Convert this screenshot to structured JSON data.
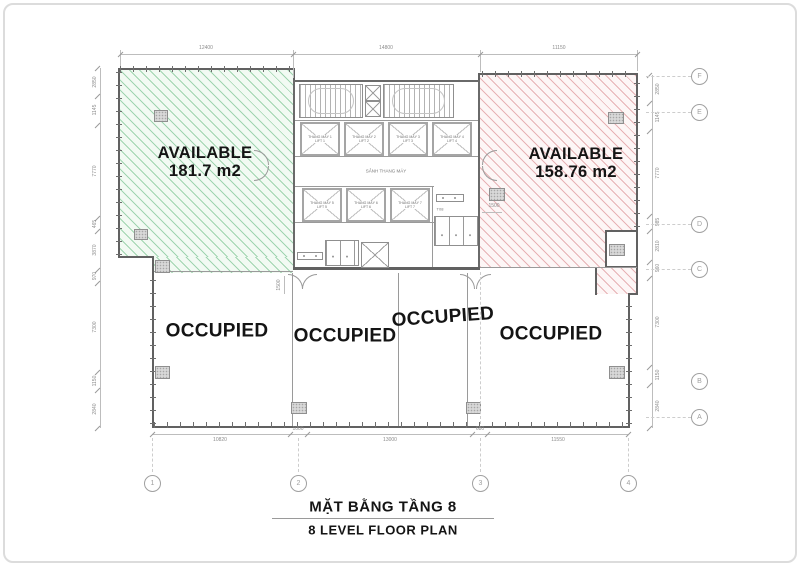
{
  "sheet": {
    "title_vi": "MẶT BẰNG TẦNG 8",
    "title_en": "8 LEVEL FLOOR PLAN"
  },
  "areas": {
    "available_left": {
      "name": "AVAILABLE",
      "area": "181.7 m2"
    },
    "available_right": {
      "name": "AVAILABLE",
      "area": "158.76 m2"
    },
    "occupied": [
      "OCCUPIED",
      "OCCUPIED",
      "OCCUPIED",
      "OCCUPIED"
    ]
  },
  "core": {
    "lobby": "SẢNH THANG MÁY",
    "wc": "T08",
    "lifts_top": [
      {
        "name": "THANG MÁY 1",
        "sub": "LIFT 1"
      },
      {
        "name": "THANG MÁY 2",
        "sub": "LIFT 2"
      },
      {
        "name": "THANG MÁY 3",
        "sub": "LIFT 3"
      },
      {
        "name": "THANG MÁY 4",
        "sub": "LIFT 4"
      }
    ],
    "lifts_bottom": [
      {
        "name": "THANG MÁY 5",
        "sub": "LIFT 5"
      },
      {
        "name": "THANG MÁY 6",
        "sub": "LIFT 6"
      },
      {
        "name": "THANG MÁY 7",
        "sub": "LIFT 7"
      }
    ]
  },
  "grid": {
    "cols": [
      "1",
      "2",
      "3",
      "4"
    ],
    "rows": [
      "F",
      "E",
      "D",
      "C",
      "B",
      "A"
    ]
  },
  "dims": {
    "top": [
      "12400",
      "14800",
      "11150"
    ],
    "bottom": [
      "10820",
      "1000",
      "13000",
      "680",
      "11550"
    ],
    "left": [
      "2850",
      "1145",
      "7770",
      "465",
      "3870",
      "970",
      "7300",
      "1150",
      "2840"
    ],
    "right": [
      "2850",
      "1145",
      "7770",
      "985",
      "2810",
      "960",
      "7300",
      "1150",
      "2840"
    ],
    "door_left": "1500",
    "door_right": "1500"
  },
  "colors": {
    "available_green": "#4daf6d",
    "available_red": "#cc5f66"
  }
}
